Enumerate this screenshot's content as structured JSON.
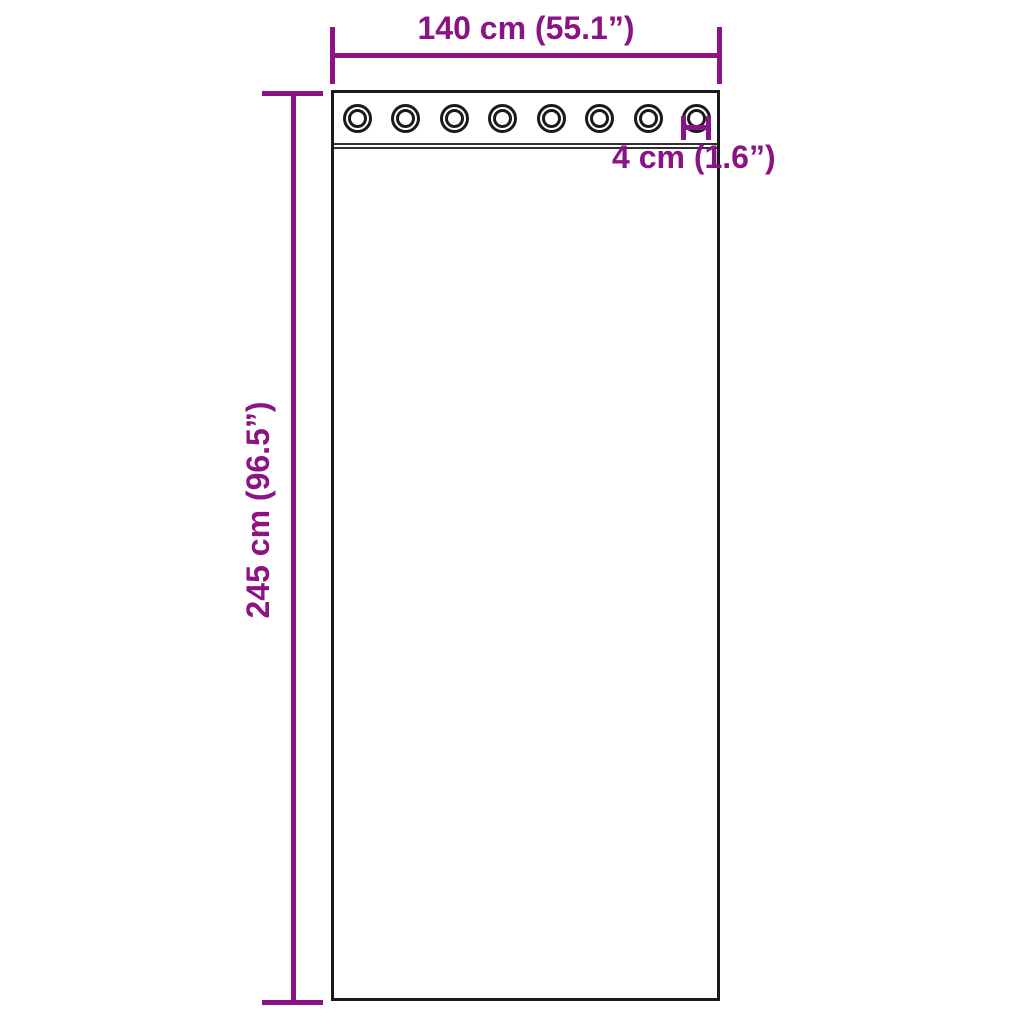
{
  "diagram": {
    "accent_color": "#8C1385",
    "outline_color": "#1A1A1A",
    "background_color": "#FFFFFF",
    "width_dimension": {
      "label": "140 cm (55.1”)"
    },
    "height_dimension": {
      "label": "245 cm (96.5”)"
    },
    "grommet_dimension": {
      "label": "4 cm (1.6”)"
    },
    "grommets": {
      "count": 8
    }
  }
}
